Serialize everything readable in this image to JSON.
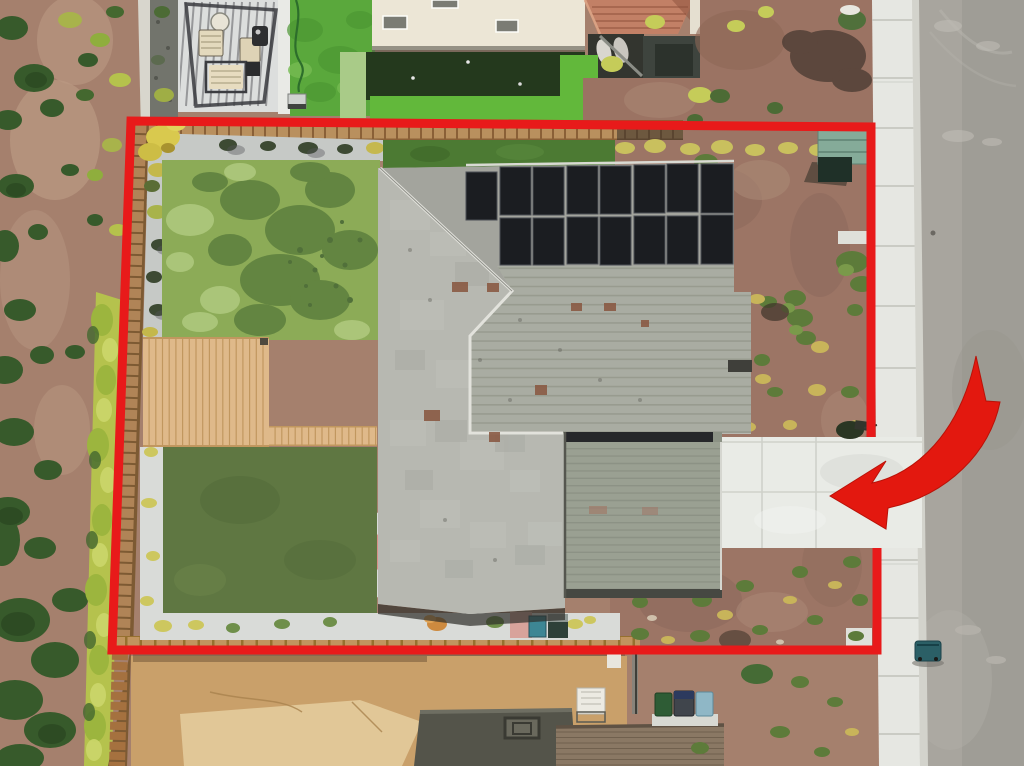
{
  "meta": {
    "description": "Aerial drone photograph of a residential corner lot, annotated with a red parcel boundary outline and a curved red arrow pointing at the driveway entrance",
    "visible_text": "none"
  },
  "annotations": {
    "boundary": {
      "name": "property-boundary",
      "color": "#e81a1a",
      "stroke_width": 9,
      "note": "outline broken at driveway entrance on right side"
    },
    "arrow": {
      "name": "pointer-arrow",
      "color": "#e3180f",
      "points_at": "driveway entrance"
    }
  },
  "colors": {
    "annotation_red": "#e81a1a",
    "arrow_red": "#e3180f",
    "mulch": "#a5806d",
    "mulch_right": "#9c7565",
    "street": "#a8a59e",
    "street_dark": "#9e9b94",
    "sidewalk": "#e6e7e2",
    "curb": "#d3d3cc",
    "driveway": "#e9ebe6",
    "lawn": "#8cab57",
    "putting_green": "#5f7742",
    "neighbor_green_dark": "#24391d",
    "neighbor_green_bright": "#62b83b",
    "neighbor_turf": "#5aa83c",
    "pale_turf": "#a9cb88",
    "roof_light": "#b7b8b1",
    "roof_mid": "#a9aca2",
    "roof_garage": "#9aa092",
    "solar_panel": "#1b1d21",
    "wood_fence": "#b9905e",
    "wood_deck": "#dfb98a",
    "concrete_pad": "#d9dbd8",
    "hedge": "#b5c24d",
    "dirt": "#c9a06a",
    "house_wall": "#ece6d6",
    "tile_roof": "#c28066",
    "utility_box": "#85ab99",
    "trash_bin": "#2b5f66",
    "bin_green": "#2e5c35",
    "bin_blue": "#8fb7c6"
  },
  "scene": {
    "subject_property": [
      "gray shingle hip roof",
      "solar panel array (2 rows)",
      "patchy natural lawn",
      "wood deck",
      "artificial putting green",
      "round patio pad",
      "bark mulch side yard",
      "concrete driveway",
      "utility box"
    ],
    "surroundings": [
      "community mulch strip with shrubs",
      "chartreuse hedge row",
      "neighbor deck with pergola and furniture",
      "neighbor putting green",
      "tile-roof house",
      "street with trash bin",
      "sidewalk",
      "rear neighbor roofs and bins"
    ]
  }
}
